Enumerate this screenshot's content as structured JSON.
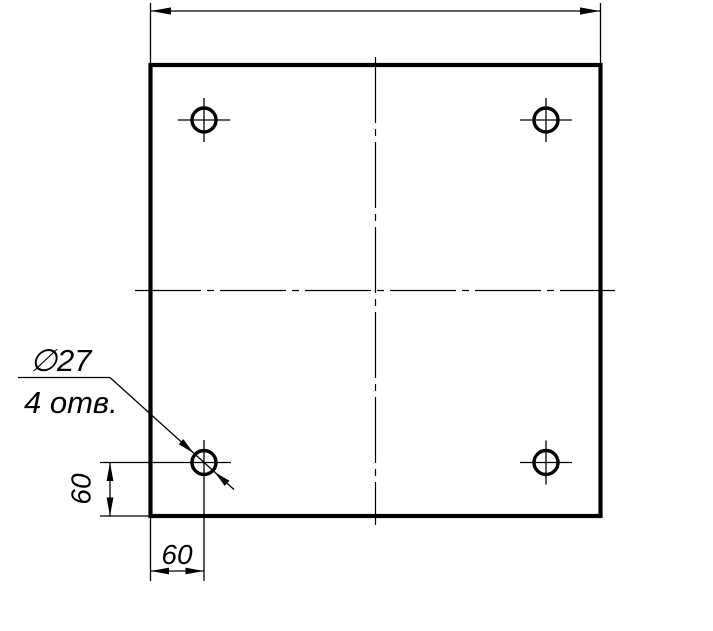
{
  "drawing": {
    "kind": "engineering-drawing",
    "description": "square plate with four drilled holes, GOST-style dimensioning",
    "background_color": "#ffffff",
    "line_color": "#000000",
    "labels": {
      "hole_diameter": "∅27",
      "hole_count": "4 отв.",
      "bottom_offset": "60",
      "left_offset": "60"
    }
  }
}
